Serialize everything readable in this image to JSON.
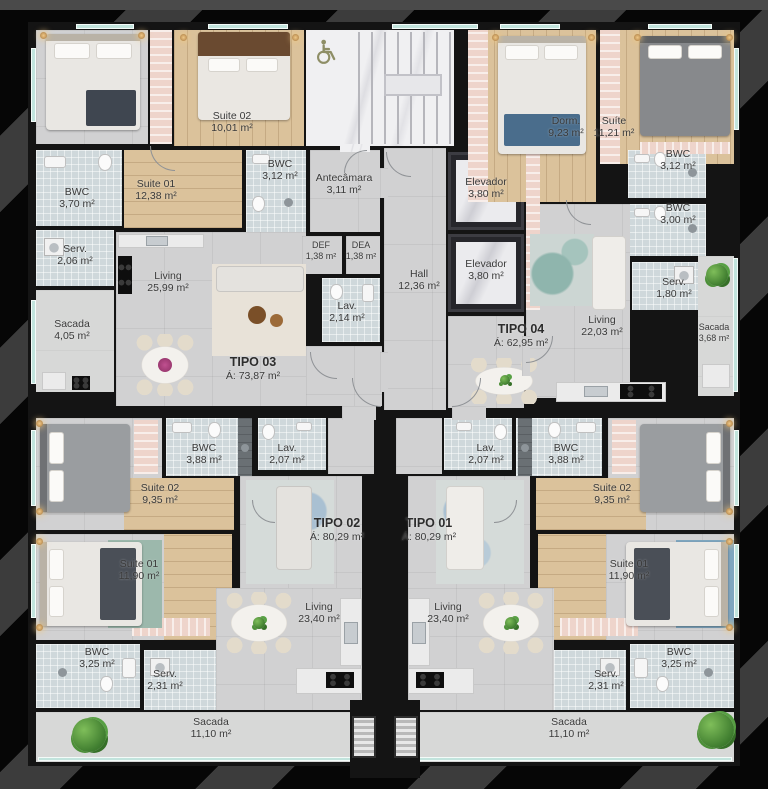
{
  "units": [
    {
      "name": "TIPO 03",
      "area": "Á: 73,87 m²"
    },
    {
      "name": "TIPO 04",
      "area": "Á: 62,95 m²"
    },
    {
      "name": "TIPO 02",
      "area": "Á: 80,29 m²"
    },
    {
      "name": "TIPO 01",
      "area": "Á: 80,29 m²"
    }
  ],
  "labels": {
    "t3_suite02": {
      "name": "Suite 02",
      "area": "10,01 m²"
    },
    "t3_bwc2": {
      "name": "BWC",
      "area": "3,12 m²"
    },
    "t3_antecamara": {
      "name": "Antecâmara",
      "area": "3,11 m²"
    },
    "t3_suite01": {
      "name": "Suite 01",
      "area": "12,38 m²"
    },
    "t3_bwc1": {
      "name": "BWC",
      "area": "3,70 m²"
    },
    "def": {
      "name": "DEF",
      "area": "1,38 m²"
    },
    "dea": {
      "name": "DEA",
      "area": "1,38 m²"
    },
    "t3_serv": {
      "name": "Serv.",
      "area": "2,06 m²"
    },
    "t3_living": {
      "name": "Living",
      "area": "25,99 m²"
    },
    "t3_sacada": {
      "name": "Sacada",
      "area": "4,05 m²"
    },
    "t3_lav": {
      "name": "Lav.",
      "area": "2,14 m²"
    },
    "hall": {
      "name": "Hall",
      "area": "12,36 m²"
    },
    "elevador1": {
      "name": "Elevador",
      "area": "3,80 m²"
    },
    "elevador2": {
      "name": "Elevador",
      "area": "3,80 m²"
    },
    "t4_dorm": {
      "name": "Dorm.",
      "area": "9,23 m²"
    },
    "t4_suite": {
      "name": "Suíte",
      "area": "11,21 m²"
    },
    "t4_bwc1": {
      "name": "BWC",
      "area": "3,12 m²"
    },
    "t4_bwc2": {
      "name": "BWC",
      "area": "3,00 m²"
    },
    "t4_serv": {
      "name": "Serv.",
      "area": "1,80 m²"
    },
    "t4_sacada": {
      "name": "Sacada",
      "area": "3,68 m²"
    },
    "t4_living": {
      "name": "Living",
      "area": "22,03 m²"
    },
    "t2_suite02": {
      "name": "Suite 02",
      "area": "9,35 m²"
    },
    "t2_bwc2": {
      "name": "BWC",
      "area": "3,88 m²"
    },
    "t2_lav": {
      "name": "Lav.",
      "area": "2,07 m²"
    },
    "t2_suite01": {
      "name": "Suite 01",
      "area": "11,90 m²"
    },
    "t2_living": {
      "name": "Living",
      "area": "23,40 m²"
    },
    "t2_bwc1": {
      "name": "BWC",
      "area": "3,25 m²"
    },
    "t2_serv": {
      "name": "Serv.",
      "area": "2,31 m²"
    },
    "t2_sacada": {
      "name": "Sacada",
      "area": "11,10 m²"
    },
    "t1_lav": {
      "name": "Lav.",
      "area": "2,07 m²"
    },
    "t1_bwc2": {
      "name": "BWC",
      "area": "3,88 m²"
    },
    "t1_suite02": {
      "name": "Suite 02",
      "area": "9,35 m²"
    },
    "t1_suite01": {
      "name": "Suite 01",
      "area": "11,90 m²"
    },
    "t1_living": {
      "name": "Living",
      "area": "23,40 m²"
    },
    "t1_serv": {
      "name": "Serv.",
      "area": "2,31 m²"
    },
    "t1_bwc1": {
      "name": "BWC",
      "area": "3,25 m²"
    },
    "t1_sacada": {
      "name": "Sacada",
      "area": "11,10 m²"
    }
  },
  "icons": {
    "wheelchair": "♿"
  },
  "colors": {
    "background": "#060606",
    "stripe": "#3c3c3c",
    "wall": "#141414",
    "floor_gray": "#d1d1d2",
    "floor_wood": "#dbc29b",
    "accent_pink": "#eed4cb",
    "bath_mosaic": "#cfd8db",
    "glass": "#c2e4dd",
    "label_text": "#3a3a3a"
  }
}
